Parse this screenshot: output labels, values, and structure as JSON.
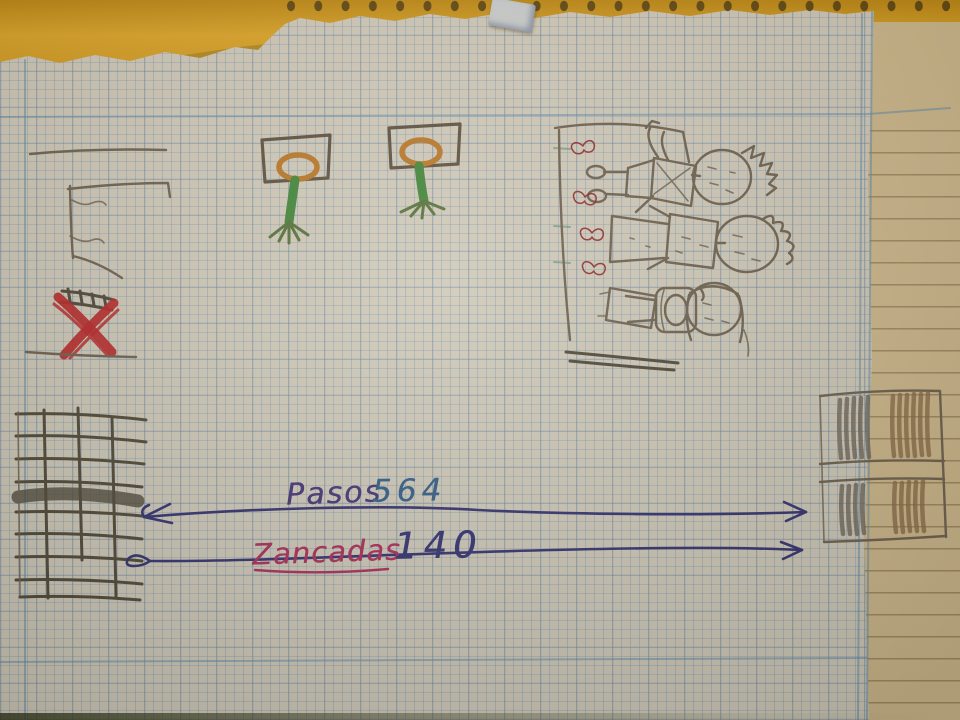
{
  "scene": {
    "description": "Photo of a child's pencil sketch on squared notebook paper: schoolyard with goal flags, ladder, crossed red ribbons, two basketball hoops, a bench with three children and red bows, and two brick walls; two long ink arrows measure the distance between the walls",
    "paper": "squared grid page torn from a spiral notebook over a yellow lined page and orange cover"
  },
  "labels": {
    "pasos_label": "Pasos",
    "pasos_value": "564",
    "zancadas_label": "Zancadas",
    "zancadas_value": "140"
  },
  "colors": {
    "paper": "#d9d3c6",
    "grid-blue": "#7ba3c4",
    "tan-page": "#d7c195",
    "desk-orange": "#e2a523",
    "hole-dark": "#57400f",
    "pencil": "#6f6354",
    "pencil-dark": "#4e483c",
    "ink-navy": "#2f2f78",
    "ink-purple": "#43317e",
    "ink-blue": "#2e5e8e",
    "ink-magenta": "#b12a5e",
    "red": "#bf2328",
    "green": "#3f8a3b",
    "ring-orange": "#c07a28",
    "board-brown": "#5d5142"
  }
}
